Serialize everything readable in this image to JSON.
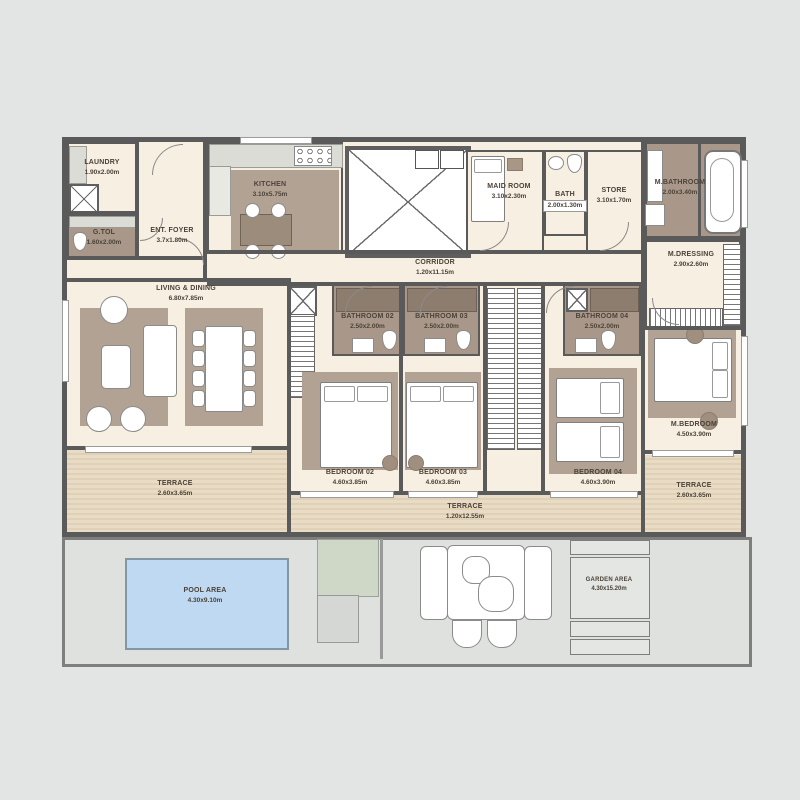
{
  "rooms": {
    "laundry": {
      "name": "LAUNDRY",
      "dim": "1.90x2.00m"
    },
    "g_tol": {
      "name": "G.TOL",
      "dim": "1.60x2.00m"
    },
    "ent_foyer": {
      "name": "ENT. FOYER",
      "dim": "3.7x1.80m"
    },
    "kitchen": {
      "name": "KITCHEN",
      "dim": "3.10x5.75m"
    },
    "maid_room": {
      "name": "MAID ROOM",
      "dim": "3.10x2.30m"
    },
    "bath": {
      "name": "BATH",
      "dim": "2.00x1.30m"
    },
    "store": {
      "name": "STORE",
      "dim": "3.10x1.70m"
    },
    "m_bathroom": {
      "name": "M.BATHROOM",
      "dim": "2.00x3.40m"
    },
    "m_dressing": {
      "name": "M.DRESSING",
      "dim": "2.90x2.60m"
    },
    "corridor": {
      "name": "CORRIDOR",
      "dim": "1.20x11.15m"
    },
    "living_dining": {
      "name": "LIVING & DINING",
      "dim": "6.80x7.85m"
    },
    "bathroom_02": {
      "name": "BATHROOM 02",
      "dim": "2.50x2.00m"
    },
    "bathroom_03": {
      "name": "BATHROOM 03",
      "dim": "2.50x2.00m"
    },
    "bathroom_04": {
      "name": "BATHROOM 04",
      "dim": "2.50x2.00m"
    },
    "bedroom_02": {
      "name": "BEDROOM 02",
      "dim": "4.60x3.85m"
    },
    "bedroom_03": {
      "name": "BEDROOM 03",
      "dim": "4.60x3.85m"
    },
    "bedroom_04": {
      "name": "BEDROOM 04",
      "dim": "4.60x3.90m"
    },
    "m_bedroom": {
      "name": "M.BEDROOM",
      "dim": "4.50x3.90m"
    },
    "terrace_left": {
      "name": "TERRACE",
      "dim": "2.60x3.65m"
    },
    "terrace_center": {
      "name": "TERRACE",
      "dim": "1.20x12.55m"
    },
    "terrace_right": {
      "name": "TERRACE",
      "dim": "2.60x3.65m"
    },
    "pool_area": {
      "name": "POOL AREA",
      "dim": "4.30x9.10m"
    },
    "garden_area": {
      "name": "GARDEN AREA",
      "dim": "4.30x15.20m"
    }
  },
  "colors": {
    "canvas_background": "#e3e5e5",
    "wall": "#5a5a5a",
    "indoor_floor": "#f7efe2",
    "carpet": "#b2a293",
    "bathroom_floor": "#a9988a",
    "terrace_wood": "#e9dcc6",
    "terrace_wood_dark": "#e0d1b6",
    "pool_water": "#bed9f1",
    "hardscape": "#dee1de",
    "shower": "#8d7d6f",
    "lawn": "#cfd8c6",
    "label_text": "#4b4238"
  }
}
